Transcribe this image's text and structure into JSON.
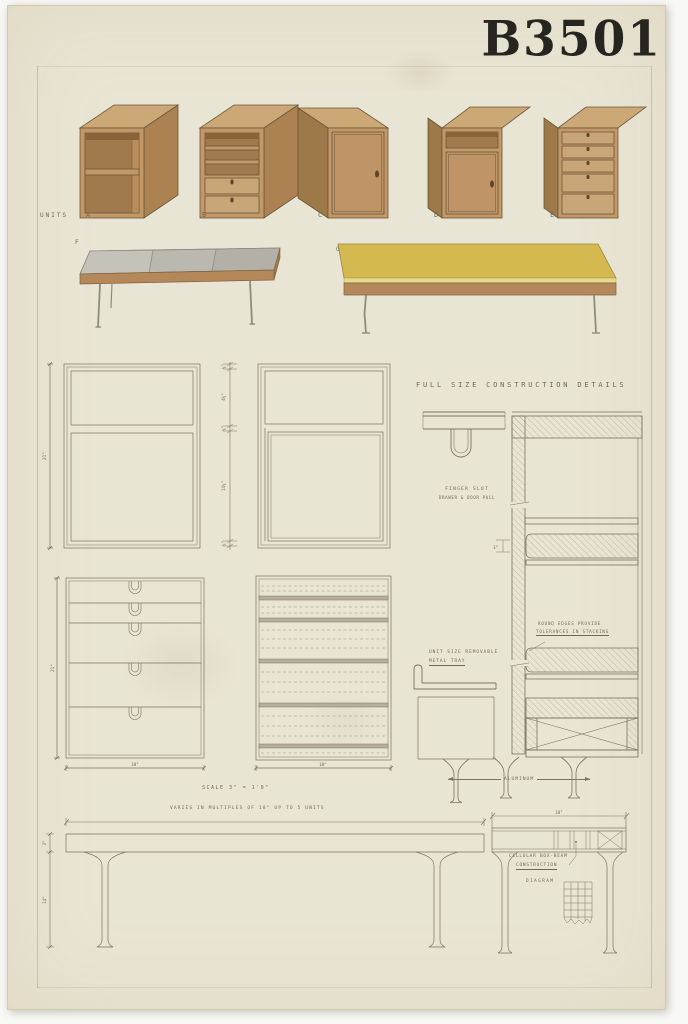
{
  "title": "B3501",
  "units_row": {
    "caption": "UNITS",
    "labels": [
      "A",
      "B",
      "C",
      "D",
      "E"
    ]
  },
  "benches": {
    "labels": [
      "F",
      "G"
    ]
  },
  "details": {
    "heading": "FULL SIZE CONSTRUCTION DETAILS",
    "finger_slot": [
      "FINGER SLOT",
      "DRAWER & DOOR PULL"
    ],
    "round_edges": [
      "ROUND EDGES PROVIDE",
      "TOLERANCES IN STACKING"
    ],
    "metal_tray": [
      "UNIT SIZE REMOVABLE",
      "METAL TRAY"
    ],
    "aluminum": "ALUMINUM",
    "cellular": [
      "CELLULAR BOX-BEAM",
      "CONSTRUCTION"
    ],
    "diagram_label": "DIAGRAM"
  },
  "notes": {
    "scale": "SCALE  3\" = 1'0\"",
    "varies": "VARIES  IN  MULTIPLES  OF  18\"  UP  TO  5  UNITS"
  },
  "dims": {
    "unit_height": "21\"",
    "drawer_height": "21\"",
    "chain": [
      "⅝\"",
      "4⅝\"",
      "⅝\"",
      "14⅝\"",
      "⅝\""
    ],
    "one_inch": "1\"",
    "drawer_width": "18\"",
    "rail_width": "18\"",
    "end_width": "18\"",
    "slab_thickness": "3\"",
    "leg_height": "14\""
  },
  "colors": {
    "paper": "#e9e5d4",
    "wood_front": "#c39868",
    "wood_top": "#cda877",
    "wood_side": "#ac8252",
    "bench_gray": "#bab8af",
    "bench_yellow": "#d3b950",
    "ink": "#26251f",
    "pencil": "#7a7262"
  }
}
